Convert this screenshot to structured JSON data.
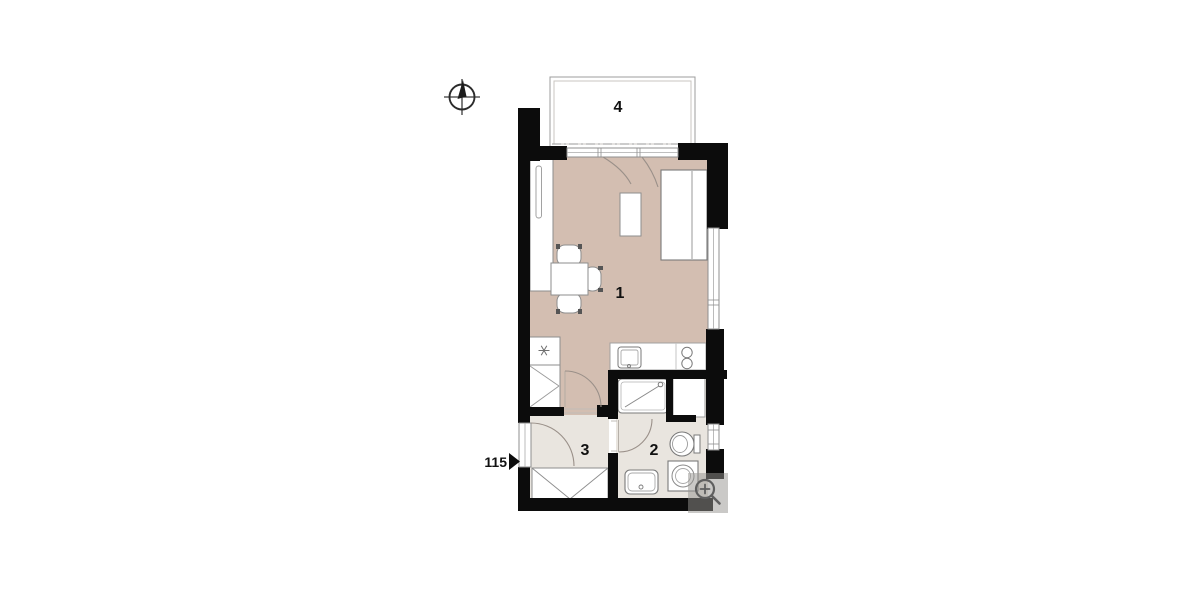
{
  "plan": {
    "unit_number": "115",
    "rooms": [
      {
        "number": "1"
      },
      {
        "number": "2"
      },
      {
        "number": "3"
      },
      {
        "number": "4"
      }
    ]
  },
  "icons": {
    "compass": "north-compass",
    "zoom_button": "zoom-in-magnifier"
  },
  "colors": {
    "living_floor": "#d3beb1",
    "hall_bath_floor": "#e9e5df",
    "wall": "#0c0c0c",
    "balcony_line": "#9c9c9c",
    "fixture_line": "#7a7a7a",
    "door_arc": "#9a9089",
    "zoom_overlay": "#969390"
  }
}
